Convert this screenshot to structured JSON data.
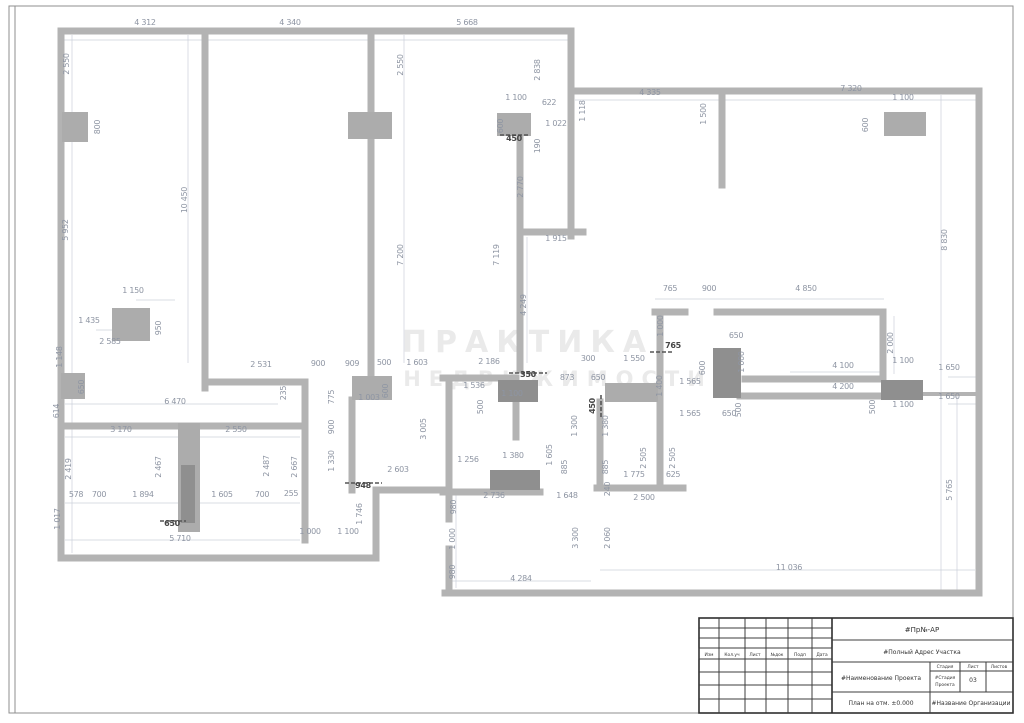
{
  "watermark": {
    "line1": "ПРАКТИКА",
    "line2": "НЕДВИЖИМОСТИ"
  },
  "title_block": {
    "project_number": "#Пр№-АР",
    "address": "#Полный Адрес Участка",
    "project_name": "#Наименование Проекта",
    "sheet_title": "План на отм. ±0.000",
    "organization": "#Название Организации",
    "stage_header": "Стадия",
    "sheet_header": "Лист",
    "sheets_header": "Листов",
    "stage_value_line1": "#Стадия",
    "stage_value_line2": "Проекта",
    "sheet_value": "03",
    "sheets_value": "",
    "rev_headers": [
      "Изм",
      "Кол.уч",
      "Лист",
      "№док",
      "Подп",
      "Дата"
    ]
  },
  "plan": {
    "dimensions": [
      {
        "t": "4 312",
        "x": 145,
        "y": 25,
        "r": 0
      },
      {
        "t": "4 340",
        "x": 290,
        "y": 25,
        "r": 0
      },
      {
        "t": "5 668",
        "x": 467,
        "y": 25,
        "r": 0
      },
      {
        "t": "2 550",
        "x": 69,
        "y": 64,
        "r": 90
      },
      {
        "t": "800",
        "x": 100,
        "y": 127,
        "r": 90
      },
      {
        "t": "2 550",
        "x": 403,
        "y": 65,
        "r": 90
      },
      {
        "t": "2 838",
        "x": 540,
        "y": 70,
        "r": 90
      },
      {
        "t": "1 100",
        "x": 516,
        "y": 100,
        "r": 0
      },
      {
        "t": "622",
        "x": 549,
        "y": 105,
        "r": 0
      },
      {
        "t": "600",
        "x": 503,
        "y": 126,
        "r": 90
      },
      {
        "t": "450",
        "x": 514,
        "y": 141,
        "r": 0,
        "d": 1
      },
      {
        "t": "1 022",
        "x": 556,
        "y": 126,
        "r": 0
      },
      {
        "t": "190",
        "x": 540,
        "y": 146,
        "r": 90
      },
      {
        "t": "1 118",
        "x": 585,
        "y": 111,
        "r": 90
      },
      {
        "t": "4 335",
        "x": 650,
        "y": 95,
        "r": 0
      },
      {
        "t": "1 500",
        "x": 706,
        "y": 114,
        "r": 90
      },
      {
        "t": "7 320",
        "x": 851,
        "y": 91,
        "r": 0
      },
      {
        "t": "1 100",
        "x": 903,
        "y": 100,
        "r": 0
      },
      {
        "t": "600",
        "x": 868,
        "y": 125,
        "r": 90
      },
      {
        "t": "8 830",
        "x": 947,
        "y": 240,
        "r": 90
      },
      {
        "t": "5 952",
        "x": 68,
        "y": 230,
        "r": 90
      },
      {
        "t": "10 450",
        "x": 187,
        "y": 200,
        "r": 90
      },
      {
        "t": "7 200",
        "x": 403,
        "y": 255,
        "r": 90
      },
      {
        "t": "7 119",
        "x": 499,
        "y": 255,
        "r": 90
      },
      {
        "t": "2 770",
        "x": 523,
        "y": 187,
        "r": 90
      },
      {
        "t": "1 915",
        "x": 556,
        "y": 241,
        "r": 0
      },
      {
        "t": "4 249",
        "x": 526,
        "y": 305,
        "r": 90
      },
      {
        "t": "1 150",
        "x": 133,
        "y": 293,
        "r": 0
      },
      {
        "t": "1 435",
        "x": 89,
        "y": 323,
        "r": 0
      },
      {
        "t": "950",
        "x": 161,
        "y": 328,
        "r": 90
      },
      {
        "t": "2 585",
        "x": 110,
        "y": 344,
        "r": 0
      },
      {
        "t": "1 148",
        "x": 62,
        "y": 357,
        "r": 90
      },
      {
        "t": "650",
        "x": 84,
        "y": 387,
        "r": 90
      },
      {
        "t": "614",
        "x": 59,
        "y": 411,
        "r": 90
      },
      {
        "t": "6 470",
        "x": 175,
        "y": 404,
        "r": 0
      },
      {
        "t": "2 531",
        "x": 261,
        "y": 367,
        "r": 0
      },
      {
        "t": "235",
        "x": 286,
        "y": 393,
        "r": 90
      },
      {
        "t": "900",
        "x": 318,
        "y": 366,
        "r": 0
      },
      {
        "t": "909",
        "x": 352,
        "y": 366,
        "r": 0
      },
      {
        "t": "500",
        "x": 384,
        "y": 365,
        "r": 0
      },
      {
        "t": "1 603",
        "x": 417,
        "y": 365,
        "r": 0
      },
      {
        "t": "2 186",
        "x": 489,
        "y": 364,
        "r": 0
      },
      {
        "t": "775",
        "x": 334,
        "y": 397,
        "r": 90
      },
      {
        "t": "900",
        "x": 334,
        "y": 427,
        "r": 90
      },
      {
        "t": "1 330",
        "x": 334,
        "y": 461,
        "r": 90
      },
      {
        "t": "600",
        "x": 388,
        "y": 391,
        "r": 90
      },
      {
        "t": "1 003",
        "x": 369,
        "y": 400,
        "r": 0
      },
      {
        "t": "3 005",
        "x": 426,
        "y": 429,
        "r": 90
      },
      {
        "t": "2 603",
        "x": 398,
        "y": 472,
        "r": 0
      },
      {
        "t": "948",
        "x": 363,
        "y": 488,
        "r": 0,
        "d": 1
      },
      {
        "t": "1 746",
        "x": 362,
        "y": 514,
        "r": 90
      },
      {
        "t": "2 667",
        "x": 297,
        "y": 467,
        "r": 90
      },
      {
        "t": "1 536",
        "x": 474,
        "y": 388,
        "r": 0
      },
      {
        "t": "1 100",
        "x": 512,
        "y": 396,
        "r": 0
      },
      {
        "t": "500",
        "x": 483,
        "y": 407,
        "r": 90
      },
      {
        "t": "350",
        "x": 528,
        "y": 377,
        "r": 0,
        "d": 1
      },
      {
        "t": "1 256",
        "x": 468,
        "y": 462,
        "r": 0
      },
      {
        "t": "1 380",
        "x": 513,
        "y": 458,
        "r": 0
      },
      {
        "t": "2 736",
        "x": 494,
        "y": 498,
        "r": 0
      },
      {
        "t": "1 648",
        "x": 567,
        "y": 498,
        "r": 0
      },
      {
        "t": "980",
        "x": 456,
        "y": 507,
        "r": 90
      },
      {
        "t": "1 000",
        "x": 455,
        "y": 539,
        "r": 90
      },
      {
        "t": "980",
        "x": 455,
        "y": 572,
        "r": 90
      },
      {
        "t": "4 284",
        "x": 521,
        "y": 581,
        "r": 0
      },
      {
        "t": "240",
        "x": 610,
        "y": 489,
        "r": 90
      },
      {
        "t": "2 500",
        "x": 644,
        "y": 500,
        "r": 0
      },
      {
        "t": "3 300",
        "x": 578,
        "y": 538,
        "r": 90
      },
      {
        "t": "2 060",
        "x": 610,
        "y": 538,
        "r": 90
      },
      {
        "t": "11 036",
        "x": 789,
        "y": 570,
        "r": 0
      },
      {
        "t": "300",
        "x": 588,
        "y": 361,
        "r": 0
      },
      {
        "t": "1 550",
        "x": 634,
        "y": 361,
        "r": 0
      },
      {
        "t": "873",
        "x": 567,
        "y": 380,
        "r": 0
      },
      {
        "t": "650",
        "x": 598,
        "y": 380,
        "r": 0
      },
      {
        "t": "765",
        "x": 670,
        "y": 291,
        "r": 0
      },
      {
        "t": "900",
        "x": 709,
        "y": 291,
        "r": 0
      },
      {
        "t": "4 850",
        "x": 806,
        "y": 291,
        "r": 0
      },
      {
        "t": "765",
        "x": 673,
        "y": 348,
        "r": 0,
        "d": 1
      },
      {
        "t": "1 000",
        "x": 663,
        "y": 326,
        "r": 90
      },
      {
        "t": "650",
        "x": 736,
        "y": 338,
        "r": 0
      },
      {
        "t": "1 400",
        "x": 662,
        "y": 386,
        "r": 90
      },
      {
        "t": "600",
        "x": 705,
        "y": 368,
        "r": 90
      },
      {
        "t": "1 000",
        "x": 744,
        "y": 362,
        "r": 90
      },
      {
        "t": "1 565",
        "x": 690,
        "y": 384,
        "r": 0
      },
      {
        "t": "1 565",
        "x": 690,
        "y": 416,
        "r": 0
      },
      {
        "t": "650",
        "x": 729,
        "y": 416,
        "r": 0
      },
      {
        "t": "500",
        "x": 741,
        "y": 410,
        "r": 90
      },
      {
        "t": "450",
        "x": 595,
        "y": 406,
        "r": 90,
        "d": 1
      },
      {
        "t": "1 300",
        "x": 577,
        "y": 426,
        "r": 90
      },
      {
        "t": "1 380",
        "x": 608,
        "y": 426,
        "r": 90
      },
      {
        "t": "885",
        "x": 567,
        "y": 467,
        "r": 90
      },
      {
        "t": "885",
        "x": 608,
        "y": 467,
        "r": 90
      },
      {
        "t": "2 505",
        "x": 646,
        "y": 458,
        "r": 90
      },
      {
        "t": "2 505",
        "x": 675,
        "y": 458,
        "r": 90
      },
      {
        "t": "1 775",
        "x": 634,
        "y": 477,
        "r": 0
      },
      {
        "t": "625",
        "x": 673,
        "y": 477,
        "r": 0
      },
      {
        "t": "1 605",
        "x": 552,
        "y": 455,
        "r": 90
      },
      {
        "t": "2 000",
        "x": 893,
        "y": 343,
        "r": 90
      },
      {
        "t": "4 100",
        "x": 843,
        "y": 368,
        "r": 0
      },
      {
        "t": "4 200",
        "x": 843,
        "y": 389,
        "r": 0
      },
      {
        "t": "1 100",
        "x": 903,
        "y": 363,
        "r": 0
      },
      {
        "t": "1 650",
        "x": 949,
        "y": 370,
        "r": 0
      },
      {
        "t": "1 650",
        "x": 949,
        "y": 399,
        "r": 0
      },
      {
        "t": "1 100",
        "x": 903,
        "y": 407,
        "r": 0
      },
      {
        "t": "500",
        "x": 875,
        "y": 407,
        "r": 90
      },
      {
        "t": "5 765",
        "x": 952,
        "y": 490,
        "r": 90
      },
      {
        "t": "3 170",
        "x": 121,
        "y": 432,
        "r": 0
      },
      {
        "t": "2 550",
        "x": 236,
        "y": 432,
        "r": 0
      },
      {
        "t": "2 419",
        "x": 71,
        "y": 469,
        "r": 90
      },
      {
        "t": "2 467",
        "x": 161,
        "y": 467,
        "r": 90
      },
      {
        "t": "2 487",
        "x": 269,
        "y": 466,
        "r": 90
      },
      {
        "t": "578",
        "x": 76,
        "y": 497,
        "r": 0
      },
      {
        "t": "700",
        "x": 99,
        "y": 497,
        "r": 0
      },
      {
        "t": "1 894",
        "x": 143,
        "y": 497,
        "r": 0
      },
      {
        "t": "1 605",
        "x": 222,
        "y": 497,
        "r": 0
      },
      {
        "t": "700",
        "x": 262,
        "y": 497,
        "r": 0
      },
      {
        "t": "255",
        "x": 291,
        "y": 496,
        "r": 0
      },
      {
        "t": "650",
        "x": 172,
        "y": 526,
        "r": 0,
        "d": 1
      },
      {
        "t": "5 710",
        "x": 180,
        "y": 541,
        "r": 0
      },
      {
        "t": "1 017",
        "x": 60,
        "y": 519,
        "r": 90
      },
      {
        "t": "1 000",
        "x": 310,
        "y": 534,
        "r": 0
      },
      {
        "t": "1 100",
        "x": 348,
        "y": 534,
        "r": 0
      }
    ]
  }
}
